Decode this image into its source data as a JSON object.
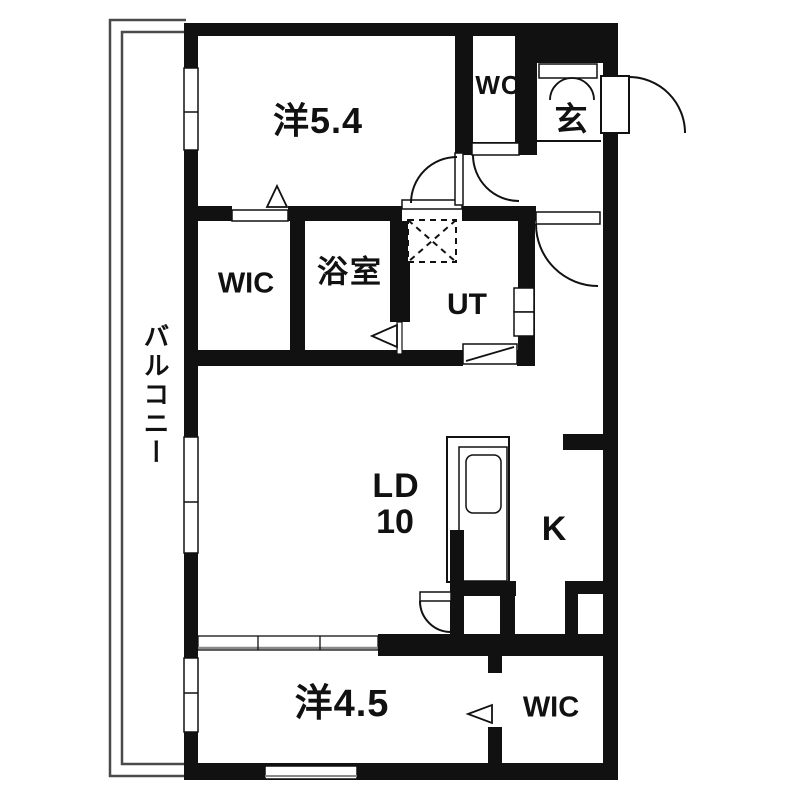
{
  "floor_plan": {
    "title": "1LDK apartment floor plan",
    "rooms": {
      "bedroom_top": {
        "label": "洋5.4"
      },
      "wc": {
        "label": "WC"
      },
      "entrance": {
        "label": "玄"
      },
      "wic_middle": {
        "label": "WIC"
      },
      "bathroom": {
        "label": "浴室"
      },
      "utility": {
        "label": "UT"
      },
      "living_dining": {
        "label": "LD",
        "size": "10"
      },
      "kitchen": {
        "label": "K"
      },
      "bedroom_bottom": {
        "label": "洋4.5"
      },
      "wic_bottom": {
        "label": "WIC"
      },
      "balcony": {
        "label": "バルコニー"
      }
    },
    "colors": {
      "wall": "#111111",
      "background": "#ffffff",
      "thin_line": "#4a4a4a",
      "sash_line": "#8a8a8a"
    }
  }
}
